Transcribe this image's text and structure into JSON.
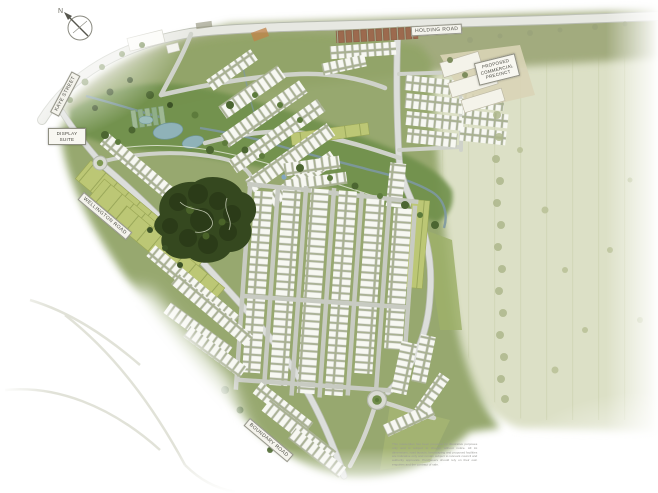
{
  "map": {
    "compass_label": "N",
    "road_labels": {
      "top": "HOLDING ROAD",
      "left": "KAYE STREET",
      "entry": "WELLINGTON ROAD",
      "south": "BOUNDARY ROAD"
    },
    "display_suite": {
      "line1": "DISPLAY",
      "line2": "SUITE"
    },
    "commercial_precinct": {
      "line1": "PROPOSED",
      "line2": "COMMERCIAL",
      "line3": "PRECINCT"
    },
    "disclaimer": "This masterplan has been prepared for illustrative purposes only and is subject to change without notice. All lot dimensions, road layouts, landscaping and proposed facilities are indicative only and remain subject to relevant council and authority approvals. Purchasers should rely on their own enquiries and the contract of sale."
  },
  "colors": {
    "page_bg": "#ffffff",
    "field_olive": "#a2ab7e",
    "paddock": "#dce0c6",
    "estate_green": "#92a468",
    "corridor_green": "#70904c",
    "forest_dark": "#35481f",
    "lot_olive": "#bcc775",
    "road_grey": "#d9dbd3",
    "house_white": "#f7f8f2",
    "water_blue": "#8fb2b8",
    "roof_red": "#9c6a4e"
  }
}
